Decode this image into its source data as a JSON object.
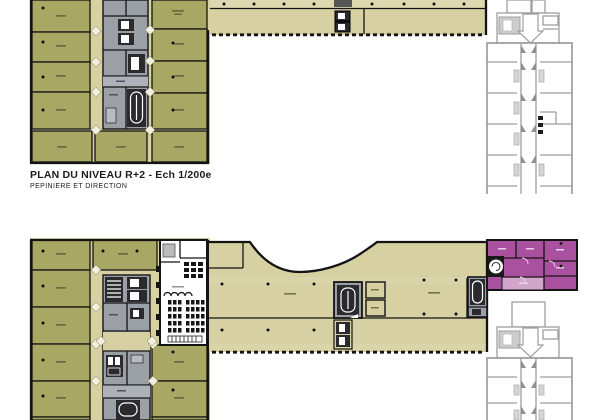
{
  "sheet": {
    "width": 600,
    "height": 420,
    "background": "#ffffff"
  },
  "title_block": {
    "main": "PLAN DU NIVEAU R+2 - Ech 1/200e",
    "sub": "PEPINIERE ET DIRECTION"
  },
  "colors": {
    "paper": "#ffffff",
    "wall": "#141414",
    "olive": "#a8a763",
    "beige": "#d6d0a2",
    "beige_light": "#ddd8b0",
    "core_gray": "#9aa0a6",
    "core_dark": "#2b2b2f",
    "outline": "#9e9e9e",
    "purple": "#a9509f",
    "purple_light": "#d2a5cb",
    "seat": "#161616",
    "label": "#5d5c38",
    "text": "#1c1c1c"
  }
}
